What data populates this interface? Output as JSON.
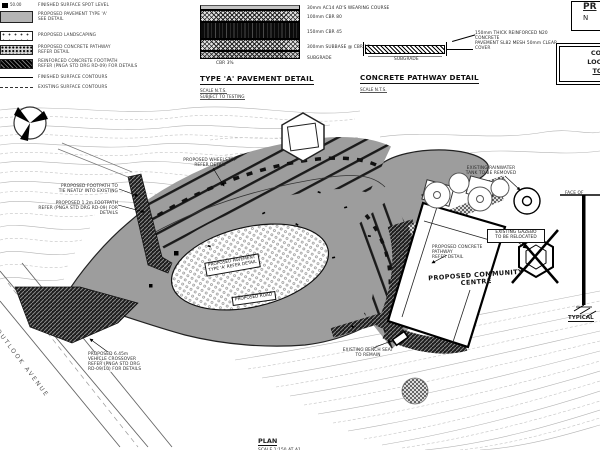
{
  "colors": {
    "pavement_gray": "#9d9d9d",
    "linework": "#1a1a1a",
    "contour": "#b8b8b8"
  },
  "legend": {
    "spot_value": "50.00",
    "items": [
      {
        "label1": "FINISHED SURFACE SPOT LEVEL",
        "label2": ""
      },
      {
        "label1": "PROPOSED PAVEMENT TYPE 'A'",
        "label2": "SEE DETAIL"
      },
      {
        "label1": "PROPOSED LANDSCAPING",
        "label2": ""
      },
      {
        "label1": "PROPOSED CONCRETE PATHWAY",
        "label2": "REFER DETAIL"
      },
      {
        "label1": "REINFORCED CONCRETE FOOTPATH",
        "label2": "REFER (PNGA STD DRG RD-09) FOR DETAILS"
      },
      {
        "label1": "FINISHED SURFACE CONTOURS",
        "label2": ""
      },
      {
        "label1": "EXISTING SURFACE CONTOURS",
        "label2": ""
      }
    ]
  },
  "pavement_detail": {
    "title": "TYPE 'A' PAVEMENT DETAIL",
    "scale": "SCALE N.T.S.",
    "note": "SUBJECT TO TESTING",
    "layers": {
      "wearing": "30mm AC14 AD'S WEARING COURSE",
      "cbr80": "100mm CBR 80",
      "cbr45": "150mm CBR 45",
      "subbase": "300mm SUBBASE @ CBR 15",
      "subgrade": "SUBGRADE"
    },
    "base_label": "CBR 3%"
  },
  "pathway_detail": {
    "title": "CONCRETE PATHWAY DETAIL",
    "scale": "SCALE N.T.S.",
    "annotation_line1": "150mm THICK REINFORCED N20 CONCRETE",
    "annotation_line2": "PAVEMENT SL82 MESH 50mm CLEAR COVER",
    "subgrade": "SUBGRADE"
  },
  "titleblock": {
    "box1_line1": "PR",
    "box1_line2": "N",
    "box2_line1": "CONT",
    "box2_line2": "LOCATE",
    "box2_line3": "TO C"
  },
  "bollard_detail": {
    "face_label": "FACE OF",
    "title": "TYPICAL"
  },
  "plan": {
    "title": "PLAN",
    "scale": "SCALE 1:150 AT A1",
    "street": "OUTLOOK AVENUE",
    "labels": {
      "footpath_tie": [
        "PROPOSED FOOTPATH TO",
        "TIE NEATLY INTO EXISTING"
      ],
      "footpath_12": [
        "PROPOSED 1.2m FOOTPATH",
        "REFER (PNGA STD DRG RD-09) FOR DETAILS"
      ],
      "wheelstop": [
        "PROPOSED WHEELSTOP",
        "REFER DETAIL"
      ],
      "rainwater": [
        "EXISTING RAINWATER",
        "TANK TO BE REMOVED"
      ],
      "gazebo": [
        "EXISTING GAZEBO",
        "TO BE RELOCATED"
      ],
      "concrete_path": [
        "PROPOSED CONCRETE",
        "PATHWAY",
        "REFER DETAIL"
      ],
      "community": [
        "PROPOSED COMMUNITY",
        "CENTRE"
      ],
      "pavement": [
        "PROPOSED PAVEMENT",
        "TYPE 'A' REFER DETAIL"
      ],
      "road": "PROPOSED ROAD",
      "bench": [
        "EXISTING BENCH SEAT",
        "TO REMAIN"
      ],
      "crossover": [
        "PROPOSED 6.45m",
        "VEHICLE CROSSOVER",
        "REFER (PNGA STD DRG",
        "RD-09/10) FOR DETAILS"
      ]
    }
  }
}
